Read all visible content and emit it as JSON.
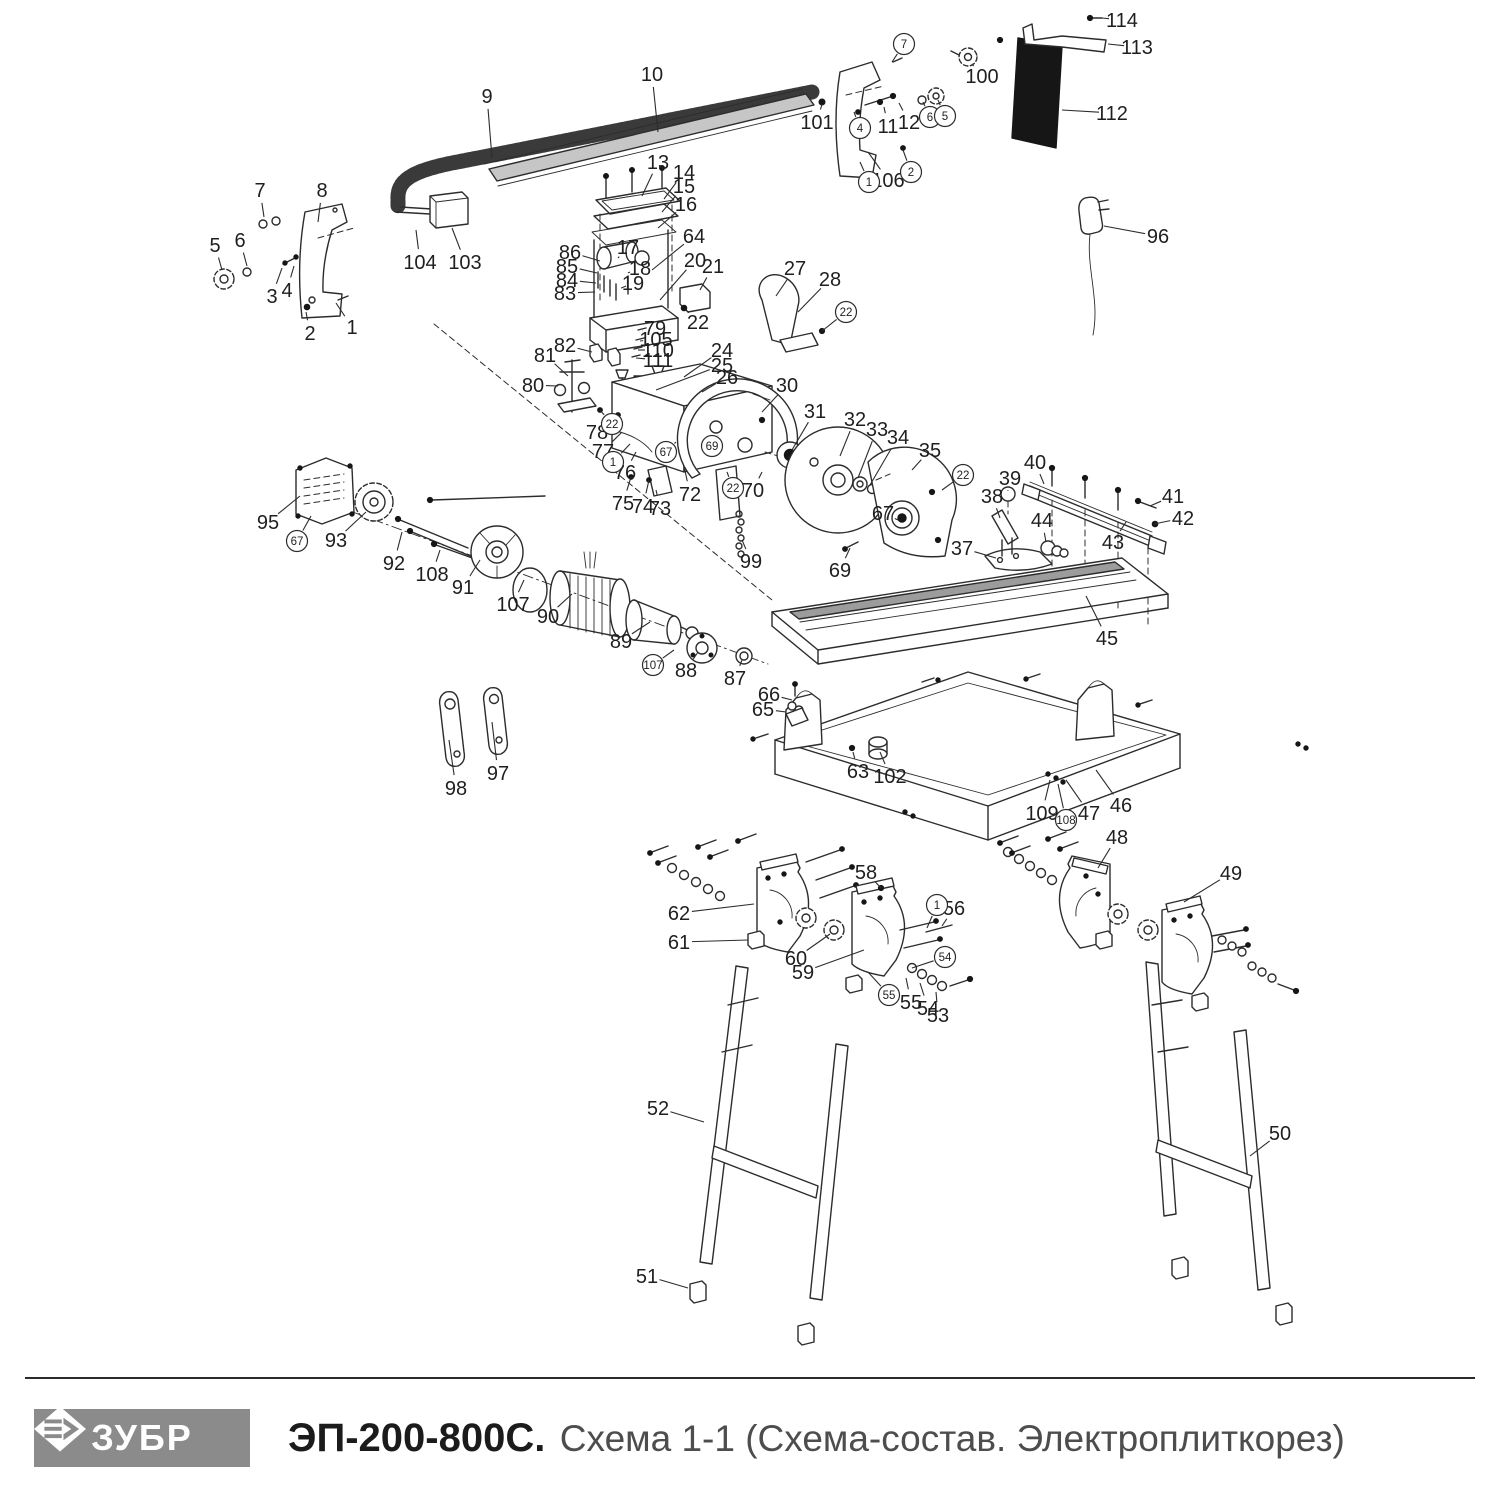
{
  "footer": {
    "logo_text": "ЗУБР",
    "model": "ЭП-200-800С.",
    "subtitle": "Схема 1-1 (Схема-состав. Электроплиткорез)"
  },
  "diagram": {
    "stroke_color": "#2c2c2c",
    "label_color": "#1f1f1f",
    "labels": [
      {
        "n": "1",
        "x": 352,
        "y": 327,
        "tx": 336,
        "ty": 303
      },
      {
        "n": "2",
        "x": 310,
        "y": 333,
        "tx": 306,
        "ty": 312
      },
      {
        "n": "3",
        "x": 272,
        "y": 296,
        "tx": 282,
        "ty": 268
      },
      {
        "n": "4",
        "x": 287,
        "y": 290,
        "tx": 294,
        "ty": 266
      },
      {
        "n": "5",
        "x": 215,
        "y": 245,
        "tx": 222,
        "ty": 270
      },
      {
        "n": "6",
        "x": 240,
        "y": 240,
        "tx": 247,
        "ty": 266
      },
      {
        "n": "7",
        "x": 260,
        "y": 190,
        "tx": 264,
        "ty": 217
      },
      {
        "n": "8",
        "x": 322,
        "y": 190,
        "tx": 318,
        "ty": 222
      },
      {
        "n": "9",
        "x": 487,
        "y": 96,
        "tx": 492,
        "ty": 158
      },
      {
        "n": "10",
        "x": 652,
        "y": 74,
        "tx": 658,
        "ty": 132
      },
      {
        "n": "103",
        "x": 465,
        "y": 262,
        "tx": 452,
        "ty": 228
      },
      {
        "n": "104",
        "x": 420,
        "y": 262,
        "tx": 416,
        "ty": 230
      },
      {
        "n": "11",
        "x": 888,
        "y": 126,
        "tx": 884,
        "ty": 107
      },
      {
        "n": "12",
        "x": 909,
        "y": 122,
        "tx": 899,
        "ty": 103
      },
      {
        "n": "101",
        "x": 817,
        "y": 122,
        "tx": 822,
        "ty": 104
      },
      {
        "n": "106",
        "x": 888,
        "y": 180,
        "tx": 868,
        "ty": 152
      },
      {
        "n": "100",
        "x": 982,
        "y": 76,
        "tx": 972,
        "ty": 64
      },
      {
        "n": "112",
        "x": 1112,
        "y": 113,
        "tx": 1062,
        "ty": 110
      },
      {
        "n": "113",
        "x": 1137,
        "y": 47,
        "tx": 1108,
        "ty": 44
      },
      {
        "n": "114",
        "x": 1122,
        "y": 20,
        "tx": 1102,
        "ty": 18
      },
      {
        "n": "96",
        "x": 1158,
        "y": 236,
        "tx": 1104,
        "ty": 226
      },
      {
        "n": "13",
        "x": 658,
        "y": 162,
        "tx": 642,
        "ty": 196
      },
      {
        "n": "14",
        "x": 684,
        "y": 172,
        "tx": 664,
        "ty": 199
      },
      {
        "n": "15",
        "x": 684,
        "y": 186,
        "tx": 662,
        "ty": 212
      },
      {
        "n": "16",
        "x": 686,
        "y": 204,
        "tx": 658,
        "ty": 228
      },
      {
        "n": "64",
        "x": 694,
        "y": 236,
        "tx": 652,
        "ty": 270
      },
      {
        "n": "86",
        "x": 570,
        "y": 252,
        "tx": 600,
        "ty": 261
      },
      {
        "n": "85",
        "x": 567,
        "y": 266,
        "tx": 597,
        "ty": 273
      },
      {
        "n": "84",
        "x": 567,
        "y": 280,
        "tx": 596,
        "ty": 283
      },
      {
        "n": "83",
        "x": 565,
        "y": 293,
        "tx": 595,
        "ty": 292
      },
      {
        "n": "17",
        "x": 628,
        "y": 247,
        "tx": 618,
        "ty": 258
      },
      {
        "n": "18",
        "x": 640,
        "y": 268,
        "tx": 630,
        "ty": 272
      },
      {
        "n": "19",
        "x": 633,
        "y": 283,
        "tx": 626,
        "ty": 286
      },
      {
        "n": "20",
        "x": 695,
        "y": 260,
        "tx": 660,
        "ty": 300
      },
      {
        "n": "21",
        "x": 713,
        "y": 266,
        "tx": 700,
        "ty": 290
      },
      {
        "n": "22",
        "x": 698,
        "y": 322,
        "tx": 686,
        "ty": 310
      },
      {
        "n": "27",
        "x": 795,
        "y": 268,
        "tx": 776,
        "ty": 296
      },
      {
        "n": "28",
        "x": 830,
        "y": 279,
        "tx": 798,
        "ty": 312
      },
      {
        "n": "79",
        "x": 655,
        "y": 328,
        "tx": 642,
        "ty": 331
      },
      {
        "n": "105",
        "x": 656,
        "y": 339,
        "tx": 640,
        "ty": 341
      },
      {
        "n": "110",
        "x": 658,
        "y": 350,
        "tx": 638,
        "ty": 350
      },
      {
        "n": "111",
        "x": 658,
        "y": 360,
        "tx": 636,
        "ty": 358
      },
      {
        "n": "82",
        "x": 565,
        "y": 345,
        "tx": 592,
        "ty": 352
      },
      {
        "n": "81",
        "x": 545,
        "y": 355,
        "tx": 568,
        "ty": 376
      },
      {
        "n": "80",
        "x": 533,
        "y": 385,
        "tx": 558,
        "ty": 386
      },
      {
        "n": "24",
        "x": 722,
        "y": 350,
        "tx": 684,
        "ty": 377
      },
      {
        "n": "25",
        "x": 722,
        "y": 365,
        "tx": 656,
        "ty": 390
      },
      {
        "n": "26",
        "x": 727,
        "y": 377,
        "tx": 702,
        "ty": 392
      },
      {
        "n": "30",
        "x": 787,
        "y": 385,
        "tx": 762,
        "ty": 412
      },
      {
        "n": "31",
        "x": 815,
        "y": 411,
        "tx": 792,
        "ty": 450
      },
      {
        "n": "32",
        "x": 855,
        "y": 419,
        "tx": 840,
        "ty": 456
      },
      {
        "n": "33",
        "x": 877,
        "y": 429,
        "tx": 858,
        "ty": 478
      },
      {
        "n": "34",
        "x": 898,
        "y": 437,
        "tx": 870,
        "ty": 485
      },
      {
        "n": "35",
        "x": 930,
        "y": 450,
        "tx": 912,
        "ty": 470
      },
      {
        "n": "39",
        "x": 1010,
        "y": 478,
        "tx": 1008,
        "ty": 490
      },
      {
        "n": "40",
        "x": 1035,
        "y": 462,
        "tx": 1044,
        "ty": 484
      },
      {
        "n": "38",
        "x": 992,
        "y": 496,
        "tx": 1000,
        "ty": 518
      },
      {
        "n": "44",
        "x": 1042,
        "y": 520,
        "tx": 1046,
        "ty": 542
      },
      {
        "n": "41",
        "x": 1173,
        "y": 496,
        "tx": 1150,
        "ty": 506
      },
      {
        "n": "42",
        "x": 1183,
        "y": 518,
        "tx": 1154,
        "ty": 524
      },
      {
        "n": "43",
        "x": 1113,
        "y": 542,
        "tx": 1126,
        "ty": 522
      },
      {
        "n": "37",
        "x": 962,
        "y": 548,
        "tx": 996,
        "ty": 558
      },
      {
        "n": "45",
        "x": 1107,
        "y": 638,
        "tx": 1086,
        "ty": 596
      },
      {
        "n": "69",
        "x": 840,
        "y": 570,
        "tx": 850,
        "ty": 548
      },
      {
        "n": "67",
        "x": 883,
        "y": 513,
        "tx": 898,
        "ty": 520
      },
      {
        "n": "70",
        "x": 753,
        "y": 490,
        "tx": 762,
        "ty": 472
      },
      {
        "n": "72",
        "x": 690,
        "y": 494,
        "tx": 684,
        "ty": 466
      },
      {
        "n": "73",
        "x": 660,
        "y": 508,
        "tx": 656,
        "ty": 490
      },
      {
        "n": "74",
        "x": 643,
        "y": 506,
        "tx": 649,
        "ty": 480
      },
      {
        "n": "75",
        "x": 623,
        "y": 503,
        "tx": 631,
        "ty": 477
      },
      {
        "n": "76",
        "x": 625,
        "y": 472,
        "tx": 636,
        "ty": 452
      },
      {
        "n": "77",
        "x": 603,
        "y": 451,
        "tx": 622,
        "ty": 432
      },
      {
        "n": "78",
        "x": 597,
        "y": 432,
        "tx": 616,
        "ty": 416
      },
      {
        "n": "95",
        "x": 268,
        "y": 522,
        "tx": 300,
        "ty": 496
      },
      {
        "n": "93",
        "x": 336,
        "y": 540,
        "tx": 366,
        "ty": 512
      },
      {
        "n": "92",
        "x": 394,
        "y": 563,
        "tx": 402,
        "ty": 532
      },
      {
        "n": "108",
        "x": 432,
        "y": 574,
        "tx": 440,
        "ty": 550
      },
      {
        "n": "91",
        "x": 463,
        "y": 587,
        "tx": 480,
        "ty": 560
      },
      {
        "n": "107",
        "x": 513,
        "y": 604,
        "tx": 524,
        "ty": 580
      },
      {
        "n": "90",
        "x": 548,
        "y": 616,
        "tx": 572,
        "ty": 594
      },
      {
        "n": "89",
        "x": 621,
        "y": 641,
        "tx": 650,
        "ty": 622
      },
      {
        "n": "88",
        "x": 686,
        "y": 670,
        "tx": 698,
        "ty": 652
      },
      {
        "n": "87",
        "x": 735,
        "y": 678,
        "tx": 742,
        "ty": 660
      },
      {
        "n": "98",
        "x": 456,
        "y": 788,
        "tx": 449,
        "ty": 740
      },
      {
        "n": "97",
        "x": 498,
        "y": 773,
        "tx": 492,
        "ty": 722
      },
      {
        "n": "99",
        "x": 751,
        "y": 561,
        "tx": 742,
        "ty": 540
      },
      {
        "n": "66",
        "x": 769,
        "y": 694,
        "tx": 792,
        "ty": 700
      },
      {
        "n": "65",
        "x": 763,
        "y": 709,
        "tx": 786,
        "ty": 712
      },
      {
        "n": "63",
        "x": 858,
        "y": 771,
        "tx": 853,
        "ty": 752
      },
      {
        "n": "102",
        "x": 890,
        "y": 776,
        "tx": 880,
        "ty": 752
      },
      {
        "n": "109",
        "x": 1042,
        "y": 813,
        "tx": 1050,
        "ty": 780
      },
      {
        "n": "47",
        "x": 1089,
        "y": 813,
        "tx": 1066,
        "ty": 780
      },
      {
        "n": "46",
        "x": 1121,
        "y": 805,
        "tx": 1096,
        "ty": 770
      },
      {
        "n": "48",
        "x": 1117,
        "y": 837,
        "tx": 1098,
        "ty": 868
      },
      {
        "n": "49",
        "x": 1231,
        "y": 873,
        "tx": 1184,
        "ty": 902
      },
      {
        "n": "62",
        "x": 679,
        "y": 913,
        "tx": 754,
        "ty": 904
      },
      {
        "n": "61",
        "x": 679,
        "y": 942,
        "tx": 748,
        "ty": 940
      },
      {
        "n": "58",
        "x": 866,
        "y": 872,
        "tx": 881,
        "ty": 888
      },
      {
        "n": "60",
        "x": 796,
        "y": 958,
        "tx": 830,
        "ty": 934
      },
      {
        "n": "59",
        "x": 803,
        "y": 972,
        "tx": 864,
        "ty": 950
      },
      {
        "n": "56",
        "x": 954,
        "y": 908,
        "tx": 942,
        "ty": 926
      },
      {
        "n": "55",
        "x": 911,
        "y": 1002,
        "tx": 906,
        "ty": 978
      },
      {
        "n": "54",
        "x": 928,
        "y": 1008,
        "tx": 920,
        "ty": 983
      },
      {
        "n": "53",
        "x": 938,
        "y": 1015,
        "tx": 936,
        "ty": 992
      },
      {
        "n": "52",
        "x": 658,
        "y": 1108,
        "tx": 704,
        "ty": 1122
      },
      {
        "n": "51",
        "x": 647,
        "y": 1276,
        "tx": 688,
        "ty": 1288
      },
      {
        "n": "50",
        "x": 1280,
        "y": 1133,
        "tx": 1250,
        "ty": 1156
      }
    ],
    "circled": [
      {
        "n": "7",
        "x": 904,
        "y": 44,
        "tx": 892,
        "ty": 62
      },
      {
        "n": "4",
        "x": 860,
        "y": 128,
        "tx": 854,
        "ty": 112
      },
      {
        "n": "1",
        "x": 869,
        "y": 182,
        "tx": 860,
        "ty": 162
      },
      {
        "n": "2",
        "x": 911,
        "y": 172,
        "tx": 903,
        "ty": 150
      },
      {
        "n": "6",
        "x": 930,
        "y": 117,
        "tx": 923,
        "ty": 102
      },
      {
        "n": "5",
        "x": 945,
        "y": 116,
        "tx": 938,
        "ty": 100
      },
      {
        "n": "22",
        "x": 846,
        "y": 312,
        "tx": 822,
        "ty": 331
      },
      {
        "n": "22",
        "x": 612,
        "y": 424,
        "tx": 600,
        "ty": 410
      },
      {
        "n": "1",
        "x": 613,
        "y": 462,
        "tx": 630,
        "ty": 444
      },
      {
        "n": "67",
        "x": 666,
        "y": 452,
        "tx": 676,
        "ty": 442
      },
      {
        "n": "69",
        "x": 712,
        "y": 446,
        "tx": 718,
        "ty": 436
      },
      {
        "n": "22",
        "x": 733,
        "y": 488,
        "tx": 727,
        "ty": 472
      },
      {
        "n": "22",
        "x": 963,
        "y": 475,
        "tx": 942,
        "ty": 490
      },
      {
        "n": "67",
        "x": 297,
        "y": 541,
        "tx": 311,
        "ty": 516
      },
      {
        "n": "107",
        "x": 653,
        "y": 665,
        "tx": 674,
        "ty": 650
      },
      {
        "n": "108",
        "x": 1066,
        "y": 820,
        "tx": 1058,
        "ty": 784
      },
      {
        "n": "1",
        "x": 937,
        "y": 905,
        "tx": 927,
        "ty": 928
      },
      {
        "n": "54",
        "x": 945,
        "y": 957,
        "tx": 912,
        "ty": 968
      },
      {
        "n": "55",
        "x": 889,
        "y": 995,
        "tx": 868,
        "ty": 972
      }
    ]
  }
}
